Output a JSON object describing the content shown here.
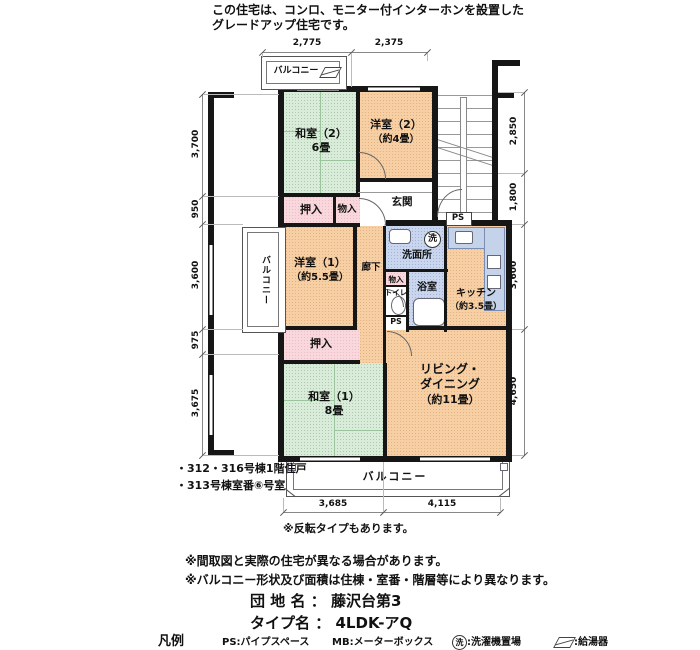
{
  "header": {
    "line1": "この住宅は、コンロ、モニター付インターホンを設置した",
    "line2": "グレードアップ住宅です。"
  },
  "rooms": {
    "washitsu2_name": "和室（2）",
    "washitsu2_size": "6畳",
    "yoshitsu2_name": "洋室（2）",
    "yoshitsu2_size": "（約4畳）",
    "yoshitsu1_name": "洋室（1）",
    "yoshitsu1_size": "（約5.5畳）",
    "washitsu1_name": "和室（1）",
    "washitsu1_size": "8畳",
    "living_line1": "リビング・",
    "living_line2": "ダイニング",
    "living_line3": "（約11畳）",
    "kitchen_name": "キッチン",
    "kitchen_size": "（約3.5畳）",
    "genkan": "玄関",
    "rouka": "廊下",
    "senmenjo": "洗面所",
    "yokushitsu": "浴室",
    "toilet": "トイレ",
    "oshiire": "押入",
    "monoiire": "物入",
    "balcony": "バルコニー",
    "ps": "PS",
    "washer": "洗"
  },
  "dims": {
    "top": [
      "2,775",
      "2,375"
    ],
    "left": [
      "3,700",
      "950",
      "3,600",
      "975",
      "3,675"
    ],
    "right": [
      "2,850",
      "1,800",
      "3,600",
      "4,650"
    ],
    "bottom": [
      "3,685",
      "4,115"
    ]
  },
  "footnotes": {
    "unit1": "・312・316号棟1階住戸",
    "unit2": "・313号棟室番⑥号室",
    "reverse": "※反転タイプもあります。"
  },
  "notes": [
    "※間取図と実際の住宅が異なる場合があります。",
    "※バルコニー形状及び面積は住棟・室番・階層等により異なります。"
  ],
  "estate": {
    "name_label": "団 地 名",
    "name_sep": "：",
    "name_value": "藤沢台第3",
    "type_label": "タイプ名",
    "type_sep": "：",
    "type_value": "4LDK-アQ"
  },
  "legend": {
    "title": "凡例",
    "ps": "PS:パイプスペース",
    "mb": "MB:メーターボックス",
    "washer": "洗",
    "washer_text": ":洗濯機置場",
    "boiler_text": ":給湯器"
  },
  "colors": {
    "tatami": "#d9ecd9",
    "western": "#f7cfa5",
    "closet": "#f8d7dd",
    "wet": "#c9d6ee",
    "wall": "#161616"
  }
}
